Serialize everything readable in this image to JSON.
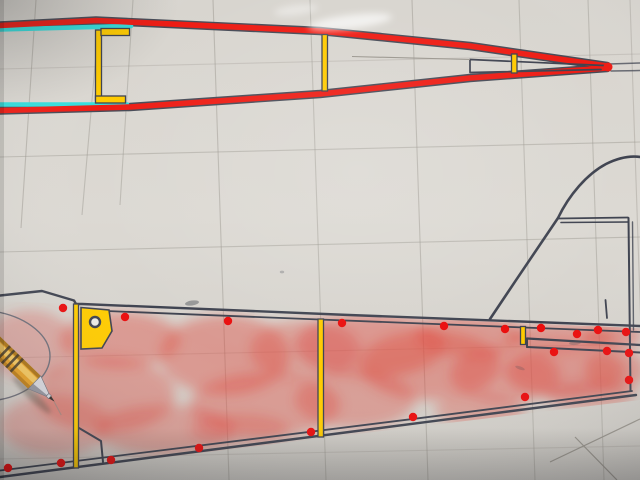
{
  "scene": {
    "subject": "photograph of hand-drawn model airplane fuselage plans on gridded paper",
    "top_view": "tapering tail boom side view outlined in red marker with cyan highlighter on inner longerons and yellow highlighted uprights",
    "bottom_view": "rear fuselage side view with tail fin, yellow highlighted formers, red airbrushed sheeting and red dot marks",
    "objects": [
      "yellow mechanical pencil lying on the plan"
    ]
  },
  "colors": {
    "paper": "#d8d5cf",
    "ink": "#3f4350",
    "pencilLine": "#9a968e",
    "redMarker": "#ee1c14",
    "cyanMarker": "#35dedd",
    "yellowMarker": "#ffcb00",
    "airbrush": "#e0493f",
    "dotRed": "#ea0d0d",
    "pencilBarrel": "#e8a32a",
    "pencilBarrelHi": "#f7cd66",
    "pencilBarrelTop": "#7e5408",
    "pencilBarrelShade": "#a66a10",
    "pencilRing": "#3a3126",
    "pencilMetal": "#d9d9df",
    "pencilMetalShade": "#84848e",
    "pencilLead": "#35302c",
    "pencilScratch": "#8f8c84",
    "pencilShadow": "#595549"
  },
  "paths": {
    "boomTop": "M0,25.5 L96,20.5 L320,31 L470,46 L607,66",
    "boomBottom": "M0,110.5 L130,107 L320,94 L470,78 L607,68",
    "cyanTop": "M0,29.5 L131,26",
    "cyanBottom": "M0,104.5 L127,104.5",
    "slotOutline": "M470,59.5 L604,65.5 M470,72.5 L601,69.5 M470,59.5 L470,72.5",
    "slotLeader": "M352,56.5 L470,59.5",
    "tipExit": "M609,64 L640,63 M611,71 L640,70.5",
    "fusTop": "M0,295.5 L42,291 L74,300.5 L76,304 L82,304 C250,312 480,319.5 640,326",
    "fusTopInner": "M82,310 C260,317.5 480,325.5 640,332",
    "fusBottom": "M0,477 C160,456 420,423 636,395",
    "fusBottomInner": "M0,470.5 C160,450.5 420,418.5 632,391",
    "noseEllipse": "M-2,312 C28,318 50,336 50,356 C50,376 28,395 -2,400",
    "cornerNotch": "M79,428 L101,441 L103,462",
    "finCurve": "M490,319 C512,286 545,237 558,218 C569,195 587,174 606,164 C621,156.5 633,156 640,157",
    "finNotchA": "M558,218.5 L628,217.5",
    "finNotchB": "M561,222.5 L628,222",
    "rudderPostA": "M628.5,218 L630.5,391",
    "rudderPostB": "M632.5,222 L633.5,330",
    "finTeShort": "M605.5,300 L607,318",
    "stabSlotA": "M527,338.5 L640,345",
    "stabSlotB": "M527,347 L640,352.5",
    "stabSlotCap": "M527,338.5 L527,347",
    "diagA": "M550,462 L640,419",
    "diagB": "M575,437 L617,480"
  },
  "gusset_points": "81,307.5 109,310 112,331 102,348 81,349",
  "shade_clip": "0,301 640,328 640,400 0,477",
  "yellow_rects": [
    [
      95.5,
      30,
      6,
      70
    ],
    [
      101,
      28.5,
      28.5,
      7
    ],
    [
      95.5,
      96,
      30,
      7
    ],
    [
      322,
      34.5,
      5.5,
      56.5
    ],
    [
      511.5,
      54,
      5.5,
      19
    ],
    [
      73.5,
      304,
      5,
      164
    ],
    [
      318,
      319,
      5.5,
      118
    ],
    [
      520.5,
      326.5,
      5,
      18
    ]
  ],
  "circles": [
    {
      "cx": 95,
      "cy": 322,
      "r": 5,
      "cls": "gusset-hole",
      "name": "gusset-hole"
    },
    {
      "cx": 608,
      "cy": 67,
      "r": 4.5,
      "cls": "tip-blob",
      "name": "boom-tip-red-blob"
    }
  ],
  "grid": [
    [
      36,
      0,
      21,
      228,
      0.5
    ],
    [
      99,
      20,
      82,
      215,
      0.45
    ],
    [
      133,
      0,
      120,
      205,
      0.45
    ],
    [
      213,
      0,
      229,
      480,
      0.5
    ],
    [
      310,
      0,
      326,
      480,
      0.45
    ],
    [
      412,
      0,
      428,
      480,
      0.5
    ],
    [
      519,
      0,
      535,
      480,
      0.45
    ],
    [
      588,
      0,
      604,
      480,
      0.45
    ],
    [
      630,
      0,
      646,
      480,
      0.4
    ],
    [
      0,
      69,
      640,
      54,
      0.3
    ],
    [
      0,
      157,
      640,
      142,
      0.45
    ],
    [
      0,
      252,
      640,
      237,
      0.45
    ],
    [
      0,
      358,
      640,
      344,
      0.3
    ],
    [
      0,
      459,
      640,
      446,
      0.3
    ]
  ],
  "dot_radius": 4.2,
  "dots": [
    [
      63,
      308
    ],
    [
      125,
      317
    ],
    [
      228,
      321
    ],
    [
      342,
      323
    ],
    [
      444,
      326
    ],
    [
      505,
      329
    ],
    [
      541,
      328
    ],
    [
      577,
      334
    ],
    [
      598,
      330
    ],
    [
      626,
      332
    ],
    [
      554,
      352
    ],
    [
      607,
      351
    ],
    [
      629,
      353
    ],
    [
      629,
      380
    ],
    [
      525,
      397
    ],
    [
      413,
      417
    ],
    [
      311,
      432
    ],
    [
      199,
      448
    ],
    [
      111,
      460
    ],
    [
      61,
      463
    ],
    [
      8,
      468
    ]
  ],
  "blobs": [
    [
      30,
      345,
      45,
      35,
      0.3
    ],
    [
      55,
      425,
      55,
      30,
      0.3
    ],
    [
      120,
      340,
      60,
      28,
      0.42
    ],
    [
      105,
      395,
      70,
      38,
      0.4
    ],
    [
      165,
      430,
      70,
      25,
      0.38
    ],
    [
      225,
      355,
      65,
      40,
      0.42
    ],
    [
      265,
      405,
      75,
      32,
      0.4
    ],
    [
      305,
      350,
      55,
      30,
      0.35
    ],
    [
      370,
      345,
      75,
      32,
      0.45
    ],
    [
      355,
      400,
      60,
      28,
      0.38
    ],
    [
      430,
      365,
      70,
      35,
      0.42
    ],
    [
      470,
      335,
      55,
      22,
      0.42
    ],
    [
      505,
      375,
      55,
      28,
      0.4
    ],
    [
      560,
      338,
      55,
      14,
      0.45
    ],
    [
      612,
      336,
      30,
      13,
      0.45
    ],
    [
      565,
      372,
      60,
      26,
      0.45
    ],
    [
      615,
      370,
      30,
      22,
      0.42
    ],
    [
      480,
      410,
      45,
      16,
      0.35
    ],
    [
      240,
      430,
      50,
      16,
      0.3
    ],
    [
      590,
      395,
      45,
      14,
      0.35
    ]
  ],
  "smudges": [
    [
      192,
      303,
      7,
      2.5,
      -8,
      0.45
    ],
    [
      282,
      272,
      2.2,
      1.4,
      0,
      0.3
    ],
    [
      575,
      343,
      6,
      2,
      -5,
      0.3
    ],
    [
      520,
      368,
      5,
      1.6,
      20,
      0.25
    ]
  ],
  "glares": [
    [
      350,
      22,
      42,
      7,
      -7,
      0.65
    ],
    [
      296,
      10,
      22,
      5,
      -7,
      0.4
    ]
  ]
}
